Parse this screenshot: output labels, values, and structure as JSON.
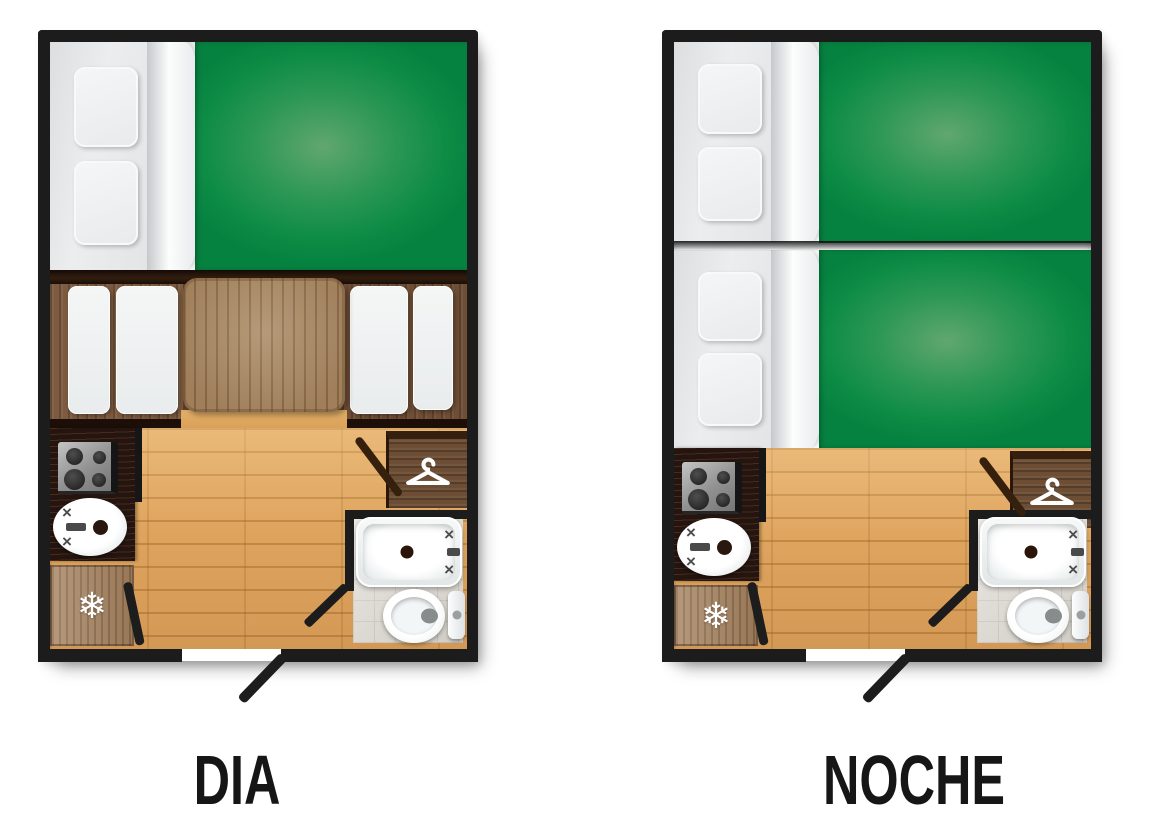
{
  "page": {
    "background": "#ffffff",
    "description": "caravan floor plans, day and night configurations"
  },
  "plans": [
    {
      "id": "dia",
      "label": "DIA"
    },
    {
      "id": "noche",
      "label": "NOCHE"
    }
  ],
  "icons": {
    "fridge": {
      "name": "snowflake-icon",
      "glyph": "❄"
    },
    "wardrobe": {
      "name": "hanger-icon"
    },
    "faucet": {
      "name": "cross-valve-icon",
      "glyph": "×"
    }
  },
  "colors": {
    "wall": "#1c1c1c",
    "blanket_dark": "#068240",
    "blanket_light": "#61a76f",
    "floor_wood": "#dfa55f",
    "counter_wood": "#241510",
    "bench_wood": "#7d5b40",
    "table_wood": "#a8865f",
    "fridge_wood": "#a5825f",
    "wardrobe_wood": "#6d4e35",
    "tile": "#d9d5cd",
    "label_text": "#161616"
  }
}
